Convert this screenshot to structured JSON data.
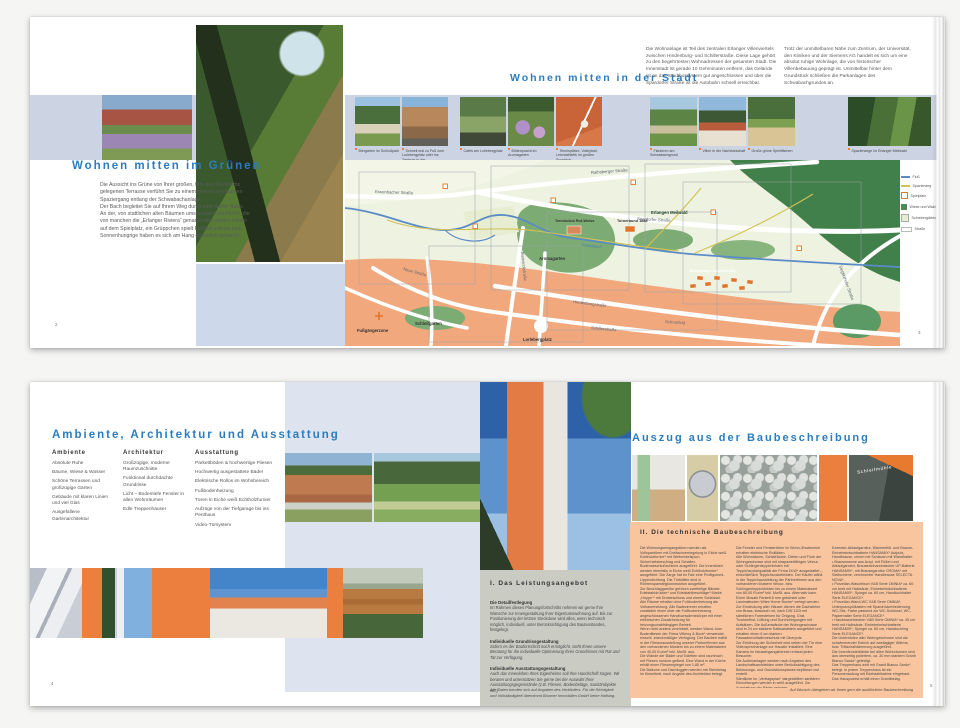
{
  "colors": {
    "headline_blue": "#2b7cbf",
    "accent_orange": "#ec7f3d",
    "band_blue": "#ccd4e3",
    "panel_orange": "#f8c59e",
    "panel_grey": "#caccc3"
  },
  "spread1": {
    "left": {
      "page_number": "2",
      "title": "Wohnen mitten im Grünen",
      "body": "Die Aussicht ins Grüne von Ihrer großen, fern des Stadtlärms gelegenen Terrasse verführt Sie zu einem kleinen erholsamen Spaziergang entlang der Schwabachanlage.\nDer Bach begleitet Sie auf Ihrem Weg durch eine reiche Natur. An der, von stattlichen alten Bäumen umsäumten Grünfläche, die von manchen die „Erlanger Riviera“ genannt wird spielen Kinder auf dem Spielplatz, ein Grüppchen spielt Fußball und ein paar Sonnenhungrige haben es sich am Hang gemütlich gemacht."
    },
    "right": {
      "page_number": "3",
      "title": "Wohnen mitten in der Stadt",
      "intro1": "Die Wohnanlage ist Teil des zentralen Erlanger Villenviertels zwischen Hindenburg- und Schillerstraße. Diese Lage gehört zu den begehrtesten Wohnadressen der gesamten Stadt. Die Innenstadt ist gerade 10 Gehminuten entfernt, das Gelände ist an das Stadtbussystem gut angeschlossen und über die Spardorfer Straße ist die Autobahn schnell erreichbar.",
      "intro2": "Trotz der unmittelbaren Nähe zum Zentrum, der Universität, den Kliniken und der Siemens AG handelt es sich um eine absolut ruhige Wohnlage, die von historischer Villenbebauung geprägt ist. Unmittelbar hinter dem Grundstück schließen die Parkanlagen des Schwabachgrundes an.",
      "captions": [
        "Biergarten im Schloßpark",
        "Schnell mal zu Fuß zum Lorlebergplatz oder ins Zentrum in die Fußgängerzone",
        "Cafés am Lorlebergplatz",
        "Blütenpracht im Aromagarten",
        "Tennisplätze, Volleyball, Leichtathletik im großen Sportclub",
        "Flanieren am Schwabachgrund",
        "Villen in der Nachbarschaft",
        "Große grüne Spielflächen",
        "Spazierwege im Erlanger Meilwald"
      ],
      "map": {
        "legend": [
          "Fluß",
          "Spazierweg",
          "Spielplatz",
          "Wiese und Wald",
          "Schrebergärten",
          "Straße"
        ],
        "streets": {
          "rathsberger": "Rathsberger Straße",
          "essenbacher": "Essenbacher Straße",
          "spardorfer": "Spardorfer Straße",
          "bismarck": "Bismarckstraße",
          "hindenburg": "Hindenburgstraße",
          "schiller": "Schillerstraße",
          "sieglitzhofer": "Sieglitzhofer Straße",
          "neue": "Neue Straße",
          "schronfeld": "Schronfeld"
        },
        "places": {
          "fussgaengerzone": "Fußgängerzone",
          "schlossgarten": "Schloßgarten",
          "lorlebergplatz": "Lorlebergplatz",
          "aromagarten": "Aromagarten",
          "tennisclub": "Tennisclub Rot-Weiss",
          "turnerbund": "Turnerbund 1888",
          "meilwald": "Erlangen Meilwald",
          "wohnanlage": "Wohnanlage Schleifmühle"
        },
        "river": "Schwabach"
      }
    }
  },
  "spread2": {
    "left": {
      "page_number": "4",
      "title": "Ambiente, Architektur und Ausstattung",
      "columns": [
        {
          "header": "Ambiente",
          "items": [
            "Absolute Ruhe",
            "Bäume, Wiese & Wasser",
            "Schöne Terrassen und großzügige Gärten",
            "Gebäude mit klaren Linien und viel Glas",
            "Ausgefallene Gartenarchitektur"
          ]
        },
        {
          "header": "Architektur",
          "items": [
            "Großzügige, moderne Raumzuschnitte",
            "Funktional durchdachte Grundrisse",
            "Licht – Bodentiefe Fenster in allen Wohnräumen",
            "Edle Treppenhäuser"
          ]
        },
        {
          "header": "Ausstattung",
          "items": [
            "Parkettböden & hochwertige Fliesen",
            "Hochwertig ausgestattete Bäder",
            "Elektrische Rollos im Wohnbereich",
            "Fußbodenheizung",
            "Türen in Eiche weiß Echtholzfurnier",
            "Aufzüge von der Tiefgarage bis ins Penthaus",
            "Video-Türsystem"
          ]
        }
      ]
    },
    "right": {
      "page_number": "5",
      "title": "Auszug aus der Baubeschreibung",
      "sign": "Schleifmühle",
      "service": {
        "header": "I. Das Leistungsangebot",
        "s1t": "Die Detailfestlegung",
        "s1b": "Im Rahmen dieses Planungsfortschritts nehmen wir gerne Ihre Wünsche zur Innengestaltung Ihrer Eigentumswohnung auf. Bis zur Positionierung der letzten Steckdose wird alles, wenn technisch möglich, individuell, unter Berücksichtigung des Bautenstandes, festgelegt.",
        "s2t": "Individuelle Grundrissgestaltung",
        "s2b": "Sofern es der Baufortschritt noch ermöglicht, steht Ihnen unsere Beratung für die individuelle Optimierung Ihres Grundrisses mit Rat und Tat zur Verfügung.",
        "s3t": "Individuelle Ausstattungsgestaltung",
        "s3b": "Auch das Innenleben Ihres Eigenheims soll Ihre Handschrift tragen. Wir beraten und unterstützen Sie gerne bei der Auswahl Ihrer Ausstattungsgegenstände (z.B. Fliesen, Bodenbeläge, Sanitärobjekte etc.)",
        "footnote": "Alle Daten berufen sich auf Angaben des Verkäufers. Für die Richtigkeit und Vollständigkeit übernimmt Brunner Immobilien GmbH keine Haftung."
      },
      "tech": {
        "header": "II. Die technische Baubeschreibung",
        "col1": "Die Wohnungseingangstüren werden als Vollspantüren mit Dreifachverriegelung in Eiche weiß Echtholzfurnier* mit Weitwinkelspion, Sicherheitsbeschlag und Schallex-Bodenabschlußschiene ausgeführt. Die Innentüren werden ebenfalls in Eiche weiß Echtholzfurnier* ausgeführt. Die Zarge hat im Falz eine Profilgummi-Lippendichtung. Die Türblätter sind in Röhrenspanstegkonstruktion ausgeführt.\nZur Beschlaggarnitur gehören zweiteilige Bänder, Edelstahldrücker* und Edelstahlbeschläge* Marke „Hoppe“* mit Drosteschloss und einem Schlüssel.\nAlle Räume erhalten eine Fußbodenheizung als Vollraumheizung. Alle Badezimmer erhalten zusätzlich einen über die Fußbodenheizung angeschlossenen Handtuchwärmekörper mit einer elektrischen Zusatzheizung für heizungsunabhängigen Betrieb.\nWenn nicht anders vereinbart, werden Wand- bzw. Bodenfliesen der Firma Villeroy & Boch* verwendet, einschl. zweckmäßiger Verfugung. Der Bauherr wählt in der Fliesenausstellung unserer Partnerfirmen aus den vorhandenen Mustern bis zu einem Materialwert von 40,00 Eur/m² inkl. MwSt. aus.\nDie Wände der Bäder und Toiletten sind raumhoch mit Fliesen rundum gefliest. Eine Wand in der Küche erhält einen Fliesenspiegel von 1,80 m².\nDie Balkone und Dachloggien werden mit Steinbelag im Kieselbett, nach Angabe des Architekten belegt.",
        "col2": "Die Fenster und Fenstertüren im Wohn-/Essbereich erhalten elektrische Rollläden.\nAlle Wohnräume, Schlafräume, Dielen und Flure der Wohngeschosse sind mit strapazierfähigen Velour- oder Schlingenteppichböden mit Teppichsockelqualität der Firma DLW* ausgestattet – einschließlich Teppichsockelleisten. Der Käufer wählt in der Teppichausstellung der Partnerfirmen aus den vorhandenen Mustern Velour- bzw. Schlingenteppichböden bis zu einem Materialwert von 60,00 Eur/m² inkl. MwSt. aus. Alternativ kann Eiche Mosaik Parkett 8 mm gebürstet oder Laminatboden Witex Home Buche* verlegt werden.\nZur Eindeckung aller Häuser dienen die Dachsteine von Braas, klassisch rot, nach DIN 1115 mit sämtlichen Formsteinen für Ortgang, Grat, Trockenfirst, Lüftung und Durchdringungen mit Aufsätzen. Die Außenwände der Wohngeschosse sind in 24 cm starkem Kalksandstein ausgeführt und erhalten einen 6 cm starken Fassadenvollwärmeschutz mit Oberputz.\nZur Erhöhung der Sicherheit wird neben der Tür eine Videosprechanlage zur Haustür installiert. Eine Kamera im Hauseingangsbereich erfasst jeden Besucher.\nDie Außenanlagen werden nach Angaben des Landschaftsarchitekten unter Berücksichtigung des Bebauungs- und Grundstücksplanes bepflanzt und erstellt.\nSämtliche im „Vertragsplan“ dargestellten sanitären Einrichtungen werden in weiß ausgeführt. Zur Ausstattung der Bäder gehören:\n• eine Badewanne aus Acryl, Modell Saturn*, mit",
        "col3": "Exzenter-Ablaufgarnitur, Wannenfüll- und Brause-Einhebelmischbatterie HANSAMIX* Aufputz, Handbrause, chrom mit Schlauch mit Wandhalter.\n• Brausewanne aus Acryl, mit Füßen und Ablaufgarnitur, Brauseeinhandmischer UP-Batterie HANSAMIX*, mit Brausegarnitur CROMA* mit Stellschiene, verchromter Handbrause SELECTA NOVA*.\n• Porzellan-Waschtisch V&B Serie OMNIA* ca. 60 cm breit mit Halbsäule, Einhebelmischbatterie HANSAMIX*, Spiegel ca. 60 cm, Handtuchhalter Serie ELEGANCE*.\n• Porzellan-Wand-WC V&B Serie OMNIA*, Unterputzspülkasten mit Spardrückerbedienung, WC-Sitz, Farbe passend zur WC-Schüssel, WC-Papierhalter Serie ELEGANCE*.\n• Handwaschbecken V&B Serie OMNIA* ca. 45 cm breit mit Halbsäule, Einhebelmischbatterie HANSAMIX*, Spiegel ca. 60 cm, Handtuchring Serie ELEGANCE*.\nDie Unterböden aller Wohngeschosse sind als schwimmender Estrich auf zweilagiger Wärme- bzw. Trittschalldämmung ausgeführt.\nDie Innenfensterbänke bei allen Wohnräumen sind aus oberseitig poliertem, ca. 30 mm starkem Granit Bianco Sardo* gefertigt.\nDas Treppenhaus wird mit Granit Bianco Sardo* belegt. In jedem Treppenhaus ist ein Personenaufzug mit Edelstahlkabine eingebaut. Das Hauspodest erhält einen Granitbelag.",
        "footer": "Auf Wunsch übergeben wir Ihnen gern die ausführliche Baubeschreibung"
      }
    }
  }
}
